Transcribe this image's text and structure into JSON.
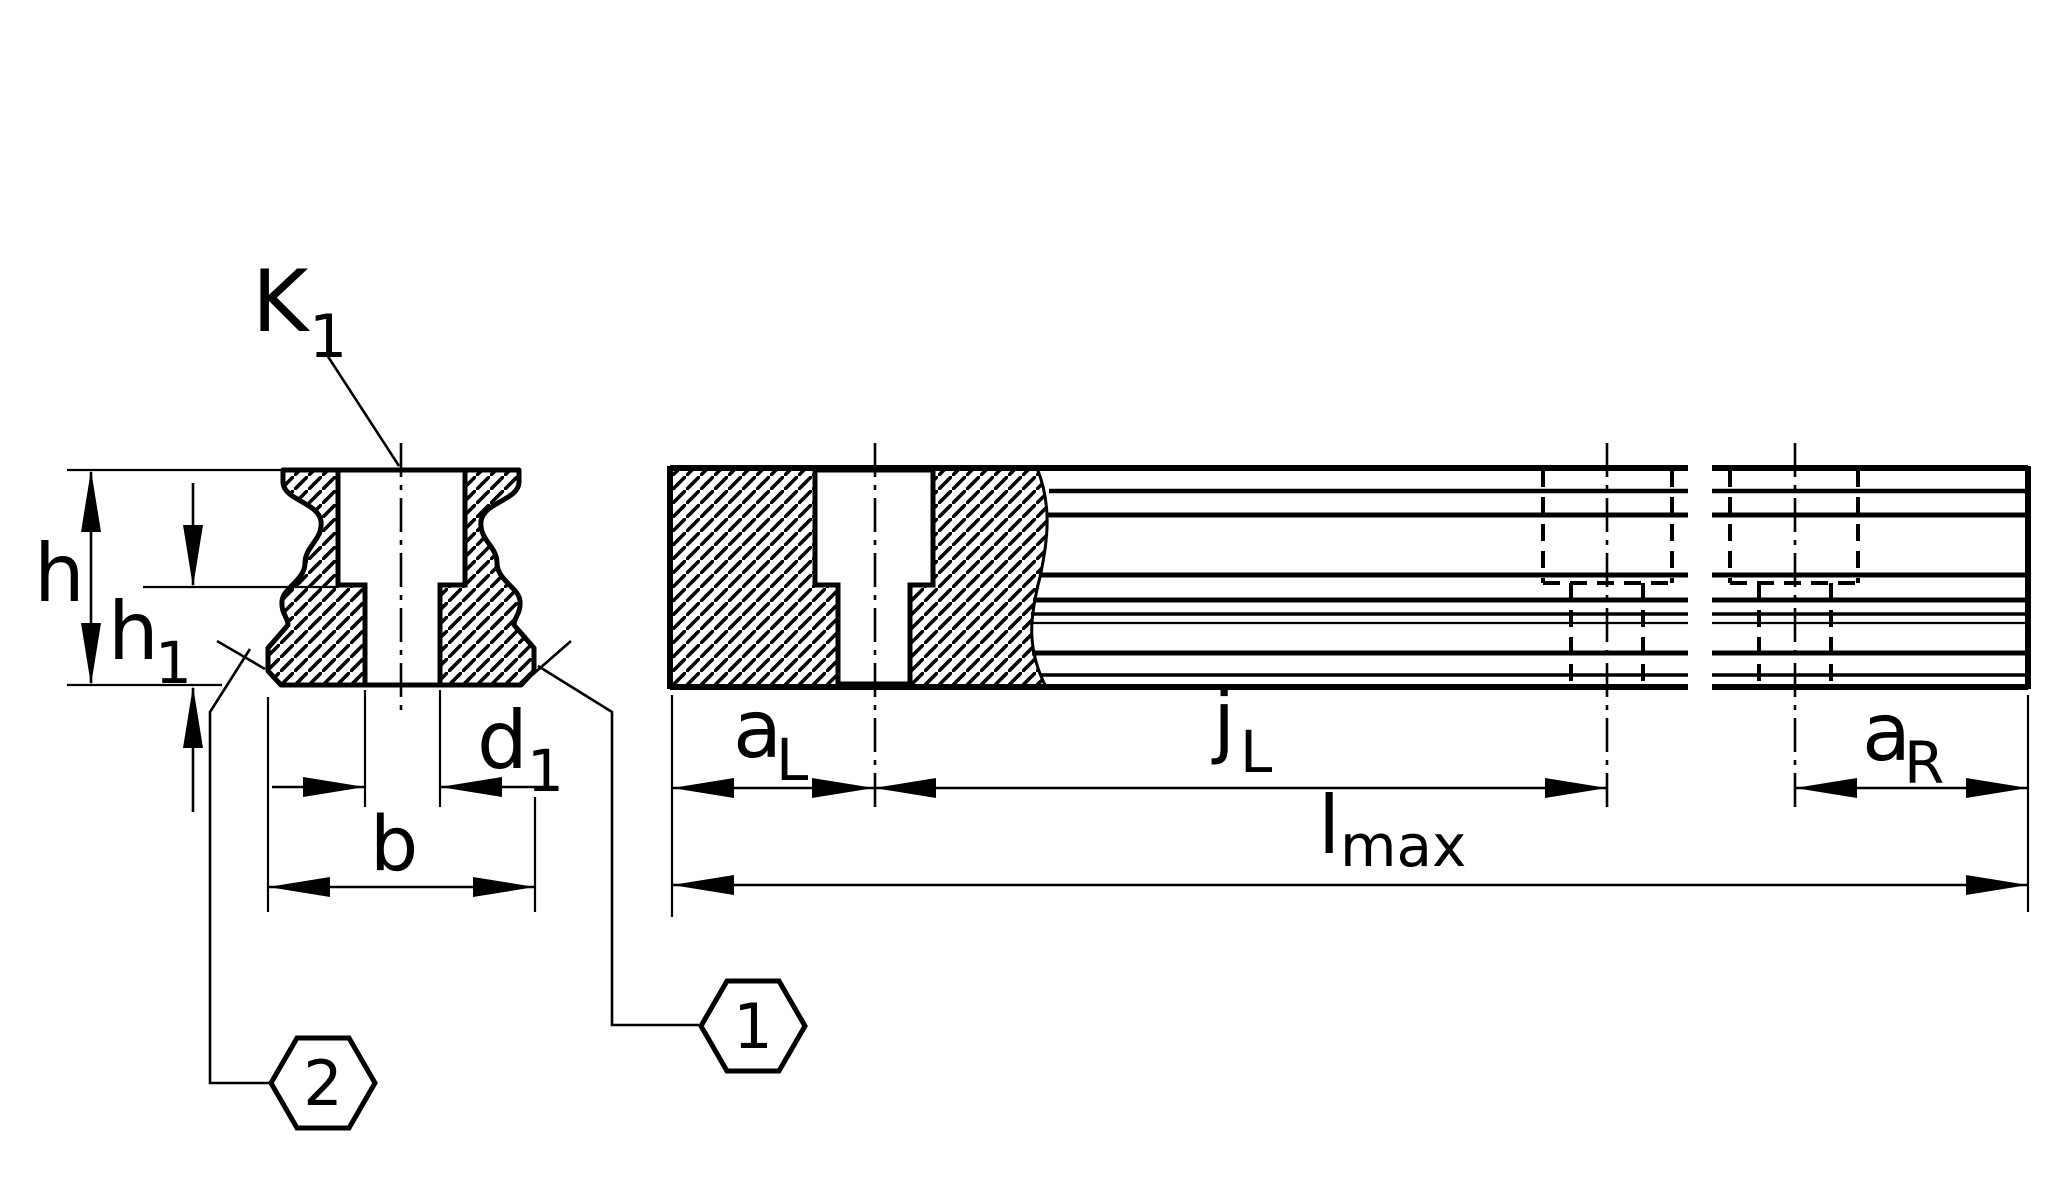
{
  "page": {
    "background": "#ffffff",
    "line_color": "#000000",
    "description": "Technical dimensional drawing of a linear guideway rail: cross-section (left) and interrupted side view (right)"
  },
  "labels": {
    "k1": {
      "base": "K",
      "sub": "1"
    },
    "h": {
      "base": "h",
      "sub": ""
    },
    "h1": {
      "base": "h",
      "sub": "1"
    },
    "d1": {
      "base": "d",
      "sub": "1"
    },
    "b": {
      "base": "b",
      "sub": ""
    },
    "a_l": {
      "base": "a",
      "sub": "L"
    },
    "j_l": {
      "base": "j",
      "sub": "L"
    },
    "a_r": {
      "base": "a",
      "sub": "R"
    },
    "l_max": {
      "base": "l",
      "sub": "max"
    }
  },
  "callouts": {
    "one": "1",
    "two": "2"
  }
}
